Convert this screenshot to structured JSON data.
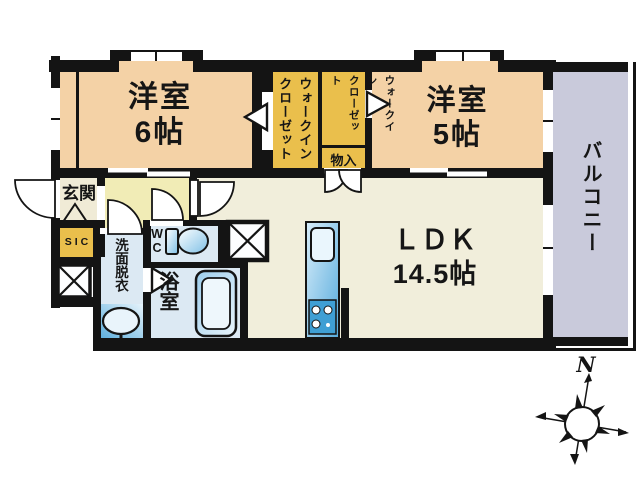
{
  "rooms": {
    "bedroom6": {
      "label": "洋室\n6帖"
    },
    "bedroom5": {
      "label": "洋室\n5帖"
    },
    "ldk": {
      "label": "ＬＤＫ\n14.5帖"
    },
    "wic_left": {
      "label": "ウォークイン\nクローゼット"
    },
    "wic_right": {
      "label": "ウォークイン\nクローゼット"
    },
    "storage": {
      "label": "物入"
    },
    "entrance": {
      "label": "玄関"
    },
    "shoe_closet": {
      "label": "SIC"
    },
    "washroom": {
      "label": "洗面脱衣"
    },
    "toilet": {
      "label": "WC"
    },
    "bath": {
      "label": "浴室"
    },
    "balcony": {
      "label": "バルコニー"
    }
  },
  "compass": {
    "north_label": "N"
  },
  "colors": {
    "wall": "#141414",
    "bedroom": "#f4d2a6",
    "closet": "#eabf4c",
    "ldk": "#f1eedb",
    "hallway": "#f1ecb6",
    "entrance": "#f0ebd6",
    "wet_room": "#dce9f3",
    "balcony": "#c9cadb",
    "fixture_blue": "#7fc0e6",
    "kitchen_blue": "#3f9fd4"
  }
}
